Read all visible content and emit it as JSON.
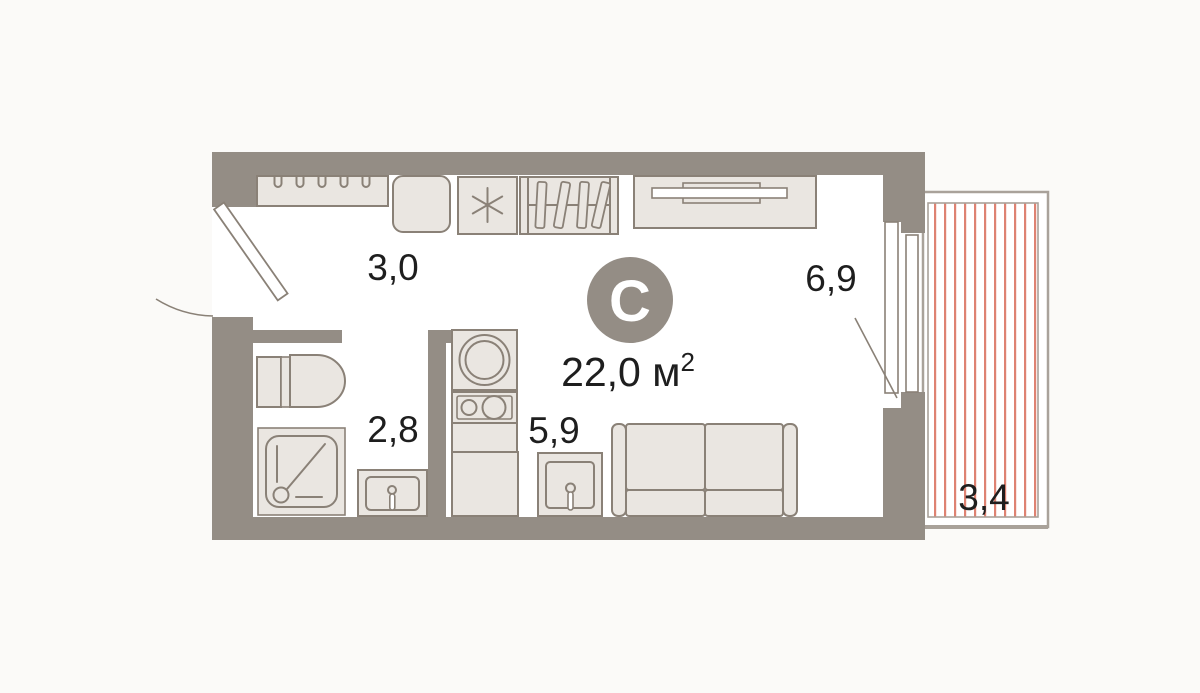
{
  "plan": {
    "logo_letter": "С",
    "total_area": {
      "value": "22,0 м",
      "superscript": "2"
    },
    "rooms": {
      "hallway": "3,0",
      "bathroom": "2,8",
      "kitchen": "5,9",
      "living": "6,9",
      "balcony": "3,4"
    }
  },
  "colors": {
    "bg": "#FBFAF8",
    "paper": "#FFFFFF",
    "wall": "#948D85",
    "furn": "#EAE6E1",
    "line": "#8A8177",
    "hatch": "#DE8272",
    "text": "#1E1E1E"
  }
}
